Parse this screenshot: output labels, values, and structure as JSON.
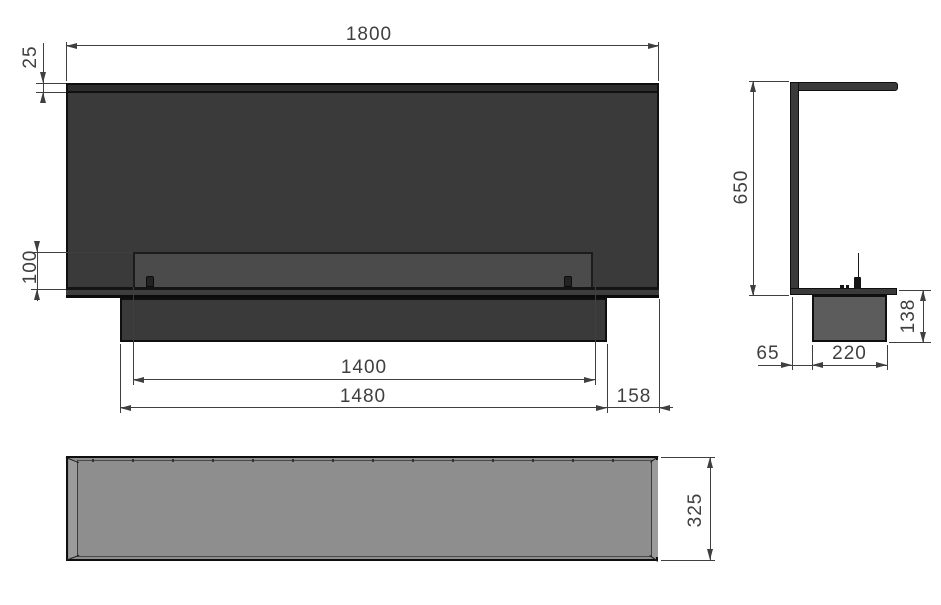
{
  "dimensions": {
    "overall_width": "1800",
    "top_frame_height": "25",
    "opening_height": "100",
    "burner_length": "1400",
    "base_length": "1480",
    "right_offset": "158",
    "overall_height": "650",
    "base_box_height": "138",
    "back_offset": "65",
    "base_box_depth": "220",
    "overall_depth": "325"
  },
  "colors": {
    "outline": "#0f0f0f",
    "panel": "#3a3a3a",
    "panel-strip": "#2d2d2d",
    "burner-opening": "#4b4b4b",
    "side-base-box": "#5c5c5c",
    "top-view-face": "#8e8e8e",
    "top-view-edge": "#9b9b9b",
    "dimension": "#3f3f3f"
  }
}
